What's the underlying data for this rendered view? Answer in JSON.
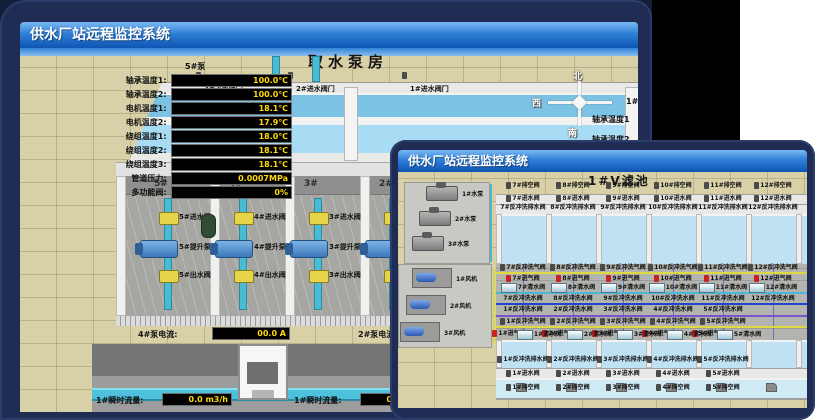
{
  "colors": {
    "title_bar_top": "#7cb9f4",
    "title_bar_bottom": "#0f54b4",
    "lcd_text": "#ffd90a",
    "sand": "#d8d1a8",
    "water": "#a8dcf4",
    "pipe_cyan": "#4fc0dc",
    "valve_yellow": "#e6d44a",
    "pump_blue": "#4f8fd0",
    "alarm_red": "#c62222"
  },
  "back_window": {
    "title": "供水厂站远程监控系统",
    "scene_title": "取水泵房",
    "pump_panel": {
      "header": "5#泵",
      "rows": [
        {
          "label": "轴承温度1:",
          "value": "100.0℃"
        },
        {
          "label": "轴承温度2:",
          "value": "100.0℃"
        },
        {
          "label": "电机温度1:",
          "value": "18.1℃"
        },
        {
          "label": "电机温度2:",
          "value": "17.9℃"
        },
        {
          "label": "绕组温度1:",
          "value": "18.0℃"
        },
        {
          "label": "绕组温度2:",
          "value": "18.1℃"
        },
        {
          "label": "绕组温度3:",
          "value": "18.1℃"
        },
        {
          "label": "管道压力:",
          "value": "0.0007MPa"
        },
        {
          "label": "多功能阀:",
          "value": "0%"
        }
      ]
    },
    "inlet_valves": [
      "3#进水阀门",
      "2#进水阀门",
      "1#进水阀门"
    ],
    "compass": {
      "north": "北",
      "west": "西",
      "south": "南"
    },
    "right_panel": {
      "header": "1#泵",
      "rows": [
        "轴承温度1",
        "轴承温度2"
      ]
    },
    "bays": [
      {
        "no": "5#",
        "inlet_valve": "5#进水阀",
        "pump": "5#提升泵",
        "outlet_valve": "5#出水阀"
      },
      {
        "no": "4#",
        "inlet_valve": "4#进水阀",
        "pump": "4#提升泵",
        "outlet_valve": "4#出水阀"
      },
      {
        "no": "3#",
        "inlet_valve": "3#进水阀",
        "pump": "3#提升泵",
        "outlet_valve": "3#出水阀"
      },
      {
        "no": "2#"
      }
    ],
    "current_displays": [
      {
        "label": "4#泵电流:",
        "value": "00.0 A"
      },
      {
        "label": "2#泵电流:",
        "value": ""
      }
    ],
    "flow_displays": [
      {
        "label": "1#瞬时流量:",
        "value": "0.0 m3/h"
      },
      {
        "label": "1#瞬时流量:",
        "value": "0.0 m3/h"
      }
    ]
  },
  "front_window": {
    "title": "供水厂站远程监控系统",
    "scene_title": "1#V滤池",
    "equipment": {
      "pumps": [
        "1#水泵",
        "2#水泵",
        "3#水泵"
      ],
      "blowers": [
        "1#风机",
        "2#风机",
        "3#风机"
      ]
    },
    "top_cells": {
      "drain_valves": [
        "7#排空阀",
        "8#排空阀",
        "9#排空阀",
        "10#排空阀",
        "11#排空阀",
        "12#排空阀"
      ],
      "inlet_valves": [
        "7#进水阀",
        "8#进水阀",
        "9#进水阀",
        "10#进水阀",
        "11#进水阀",
        "12#进水阀"
      ],
      "backwash_drain_valves": [
        "7#反冲洗排水阀",
        "8#反冲洗排水阀",
        "9#反冲洗排水阀",
        "10#反冲洗排水阀",
        "11#反冲洗排水阀",
        "12#反冲洗排水阀"
      ],
      "backwash_air_valves": [
        "7#反冲洗气阀",
        "8#反冲洗气阀",
        "9#反冲洗气阀",
        "10#反冲洗气阀",
        "11#反冲洗气阀",
        "12#反冲洗气阀"
      ],
      "air_inlet_valves": [
        "7#进气阀",
        "8#进气阀",
        "9#进气阀",
        "10#进气阀",
        "11#进气阀",
        "12#进气阀"
      ],
      "clean_water_valves": [
        "7#清水阀",
        "8#清水阀",
        "9#清水阀",
        "10#清水阀",
        "11#清水阀",
        "12#清水阀"
      ],
      "backwash_water_valves": [
        "7#反冲洗水阀",
        "8#反冲洗水阀",
        "9#反冲洗水阀",
        "10#反冲洗水阀",
        "11#反冲洗水阀",
        "12#反冲洗水阀"
      ]
    },
    "bottom_cells": {
      "backwash_water_valves": [
        "1#反冲洗水阀",
        "2#反冲洗水阀",
        "3#反冲洗水阀",
        "4#反冲洗水阀",
        "5#反冲洗水阀"
      ],
      "backwash_air_valves": [
        "1#反冲洗气阀",
        "2#反冲洗气阀",
        "3#反冲洗气阀",
        "4#反冲洗气阀",
        "5#反冲洗气阀"
      ],
      "air_inlet_valves": [
        "1#进气阀",
        "2#进气阀",
        "3#进气阀",
        "4#进气阀",
        "5#进气阀"
      ],
      "clean_water_valves": [
        "1#清水阀",
        "2#清水阀",
        "3#清水阀",
        "4#清水阀",
        "5#清水阀"
      ],
      "backwash_drain_valves": [
        "1#反冲洗排水阀",
        "2#反冲洗排水阀",
        "3#反冲洗排水阀",
        "4#反冲洗排水阀",
        "5#反冲洗排水阀"
      ],
      "inlet_valves": [
        "1#进水阀",
        "2#进水阀",
        "3#进水阀",
        "4#进水阀",
        "5#进水阀"
      ],
      "drain_valves": [
        "1#排空阀",
        "2#排空阀",
        "3#排空阀",
        "4#排空阀",
        "5#排空阀"
      ]
    }
  }
}
